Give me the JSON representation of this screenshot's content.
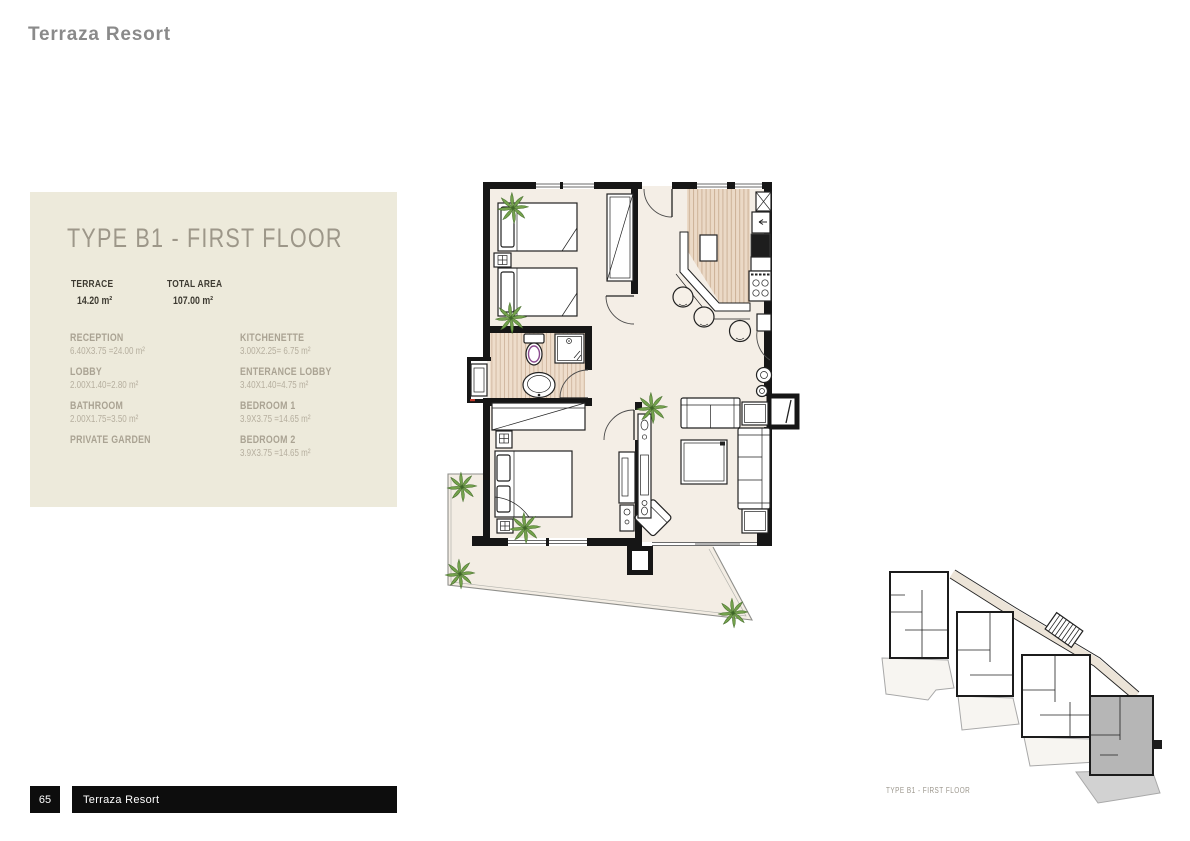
{
  "page": {
    "title": "Terraza Resort",
    "number": "65",
    "footer_title": "Terraza Resort"
  },
  "panel": {
    "heading": "TYPE B1 - FIRST FLOOR",
    "stats": [
      {
        "label": "TERRACE",
        "value": "14.20 m²"
      },
      {
        "label": "TOTAL AREA",
        "value": "107.00 m²"
      }
    ],
    "rooms_left": [
      {
        "name": "RECEPTION",
        "dims": "6.40X3.75 =24.00 m²"
      },
      {
        "name": "LOBBY",
        "dims": "2.00X1.40=2.80 m²"
      },
      {
        "name": "BATHROOM",
        "dims": "2.00X1.75=3.50 m²"
      },
      {
        "name": "PRIVATE GARDEN",
        "dims": ""
      }
    ],
    "rooms_right": [
      {
        "name": "KITCHENETTE",
        "dims": "3.00X2.25= 6.75 m²"
      },
      {
        "name": "ENTERANCE LOBBY",
        "dims": "3.40X1.40=4.75 m²"
      },
      {
        "name": "BEDROOM 1",
        "dims": "3.9X3.75 =14.65 m²"
      },
      {
        "name": "BEDROOM 2",
        "dims": "3.9X3.75 =14.65 m²"
      }
    ]
  },
  "keyplan": {
    "caption": "TYPE B1 - FIRST FLOOR",
    "highlight_color": "#b6b6b6"
  },
  "colors": {
    "panel_bg": "#edeadb",
    "heading_text": "#9d9789",
    "dark_text": "#3d3a31",
    "muted_text": "#aaa393",
    "wall": "#161616",
    "floor": "#f4eee6",
    "wood_floor": "#ebd9c6",
    "palm_green": "#74a24c",
    "toilet_accent": "#8a4a8e",
    "footer_bg": "#0d0d0d",
    "title_gray": "#8a8a8a"
  }
}
